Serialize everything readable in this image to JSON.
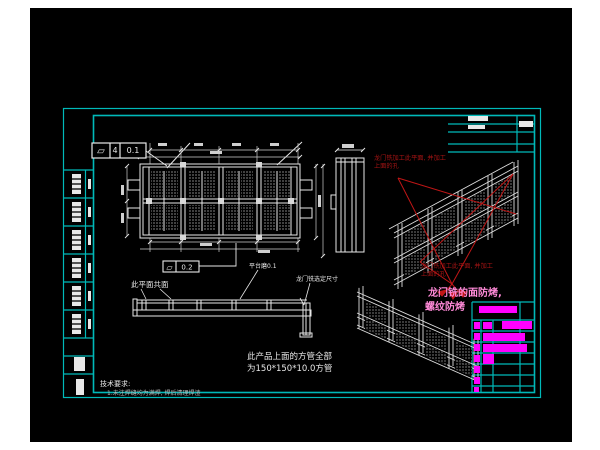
{
  "colors": {
    "page_bg": "#ffffff",
    "canvas_bg": "#000000",
    "frame_cyan": "#00b9b9",
    "line_white": "#e8e8e8",
    "annotation_red": "#a81414",
    "magenta": "#ff00ff",
    "note_pink": "#ff8ad8"
  },
  "tolerance_frames": {
    "flatness_top": {
      "symbol": "▱",
      "datum": "4",
      "value": "0.1"
    },
    "flatness_mid": {
      "symbol": "▱",
      "value": "0.2"
    }
  },
  "annotations": {
    "coplanar_label": "此平面共面",
    "platform_allowance": "平台磨0.1",
    "gantry_mill_size": "龙门铣选定尺寸",
    "red_note_top_line1": "龙门铣加工此平面, 并加工",
    "red_note_top_line2": "上面的孔",
    "red_note_mid_line1": "龙门铣加工此平面, 并加工",
    "red_note_mid_line2": "上面的孔",
    "magenta_note_line1": "龙门铣的面防烤,",
    "magenta_note_line2": "螺纹防烤",
    "square_tube_note_line1": "此产品上面的方管全部",
    "square_tube_note_line2": "为150*150*10.0方管",
    "tech_req_title": "技术要求:",
    "tech_req_item1": "1.未注焊缝均为满焊, 焊后清理焊渣"
  }
}
